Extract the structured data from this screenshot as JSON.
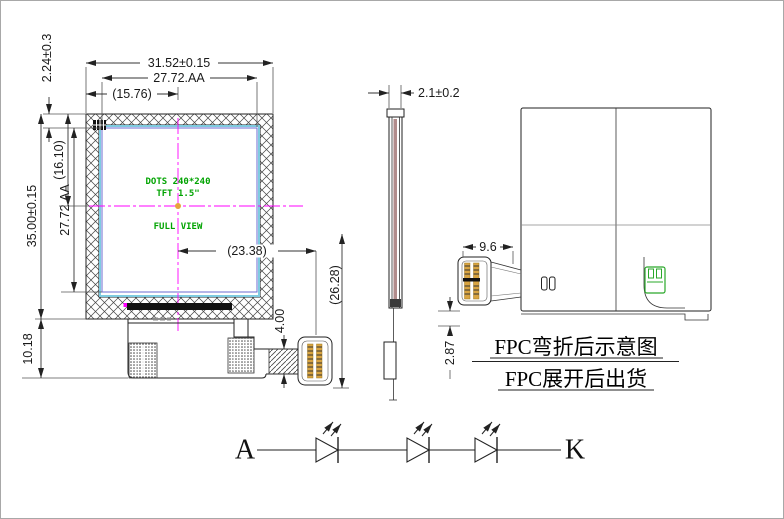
{
  "front_view": {
    "dims": {
      "outline_width": "31.52±0.15",
      "aa_width": "27.72.AA",
      "half_width": "(15.76)",
      "top_margin": "2.24±0.3",
      "outline_height": "35.00±0.15",
      "aa_height": "27.72.AA",
      "center_height": "(16.10)",
      "fpc_length": "10.18",
      "connector_offset": "(23.38)",
      "connector_drop": "(26.28)",
      "tail_width": "4.00"
    },
    "screen": {
      "line1": "DOTS 240*240",
      "line2": "TFT 1.5\"",
      "line3": "FULL VIEW"
    }
  },
  "side_view": {
    "dims": {
      "thickness": "2.1±0.2"
    }
  },
  "back_view": {
    "dims": {
      "connector_width": "9.6",
      "fpc_drop": "2.87"
    }
  },
  "notes": {
    "folded": "FPC弯折后示意图",
    "shipped": "FPC展开后出货"
  },
  "led_diagram": {
    "anode": "A",
    "cathode": "K"
  },
  "colors": {
    "centerline": "#ff00ff",
    "screen_text": "#00a300",
    "glass_border": "#7ecbe0",
    "aa_border": "#6b6bd0",
    "pin_gold": "#d9a441",
    "connector_mark_green": "#2aa82a",
    "line": "#222222"
  }
}
